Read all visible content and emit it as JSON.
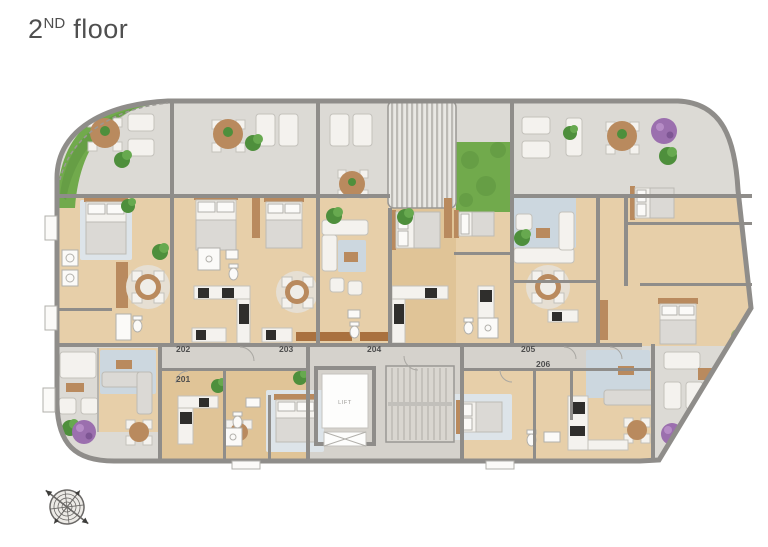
{
  "title": {
    "number": "2",
    "ordinal": "ND",
    "word": "floor"
  },
  "units": {
    "u201": "201",
    "u202": "202",
    "u203": "203",
    "u204": "204",
    "u205": "205",
    "u206": "206"
  },
  "lift_label": "LIFT",
  "icons": {
    "compass": "compass-rose-icon"
  },
  "colors": {
    "terrace": "#dcdad5",
    "wood": "#e7cfa9",
    "wall": "#8f8d8a",
    "grass": "#71aa4c",
    "rug": "#ccd7df",
    "white_furniture": "#f4f2ee",
    "appliance": "#2f2e2c",
    "corridor": "#d5d2cc",
    "text": "#4f4f4f",
    "purple": "#9b6fae",
    "wooddark": "#b98a5e"
  }
}
